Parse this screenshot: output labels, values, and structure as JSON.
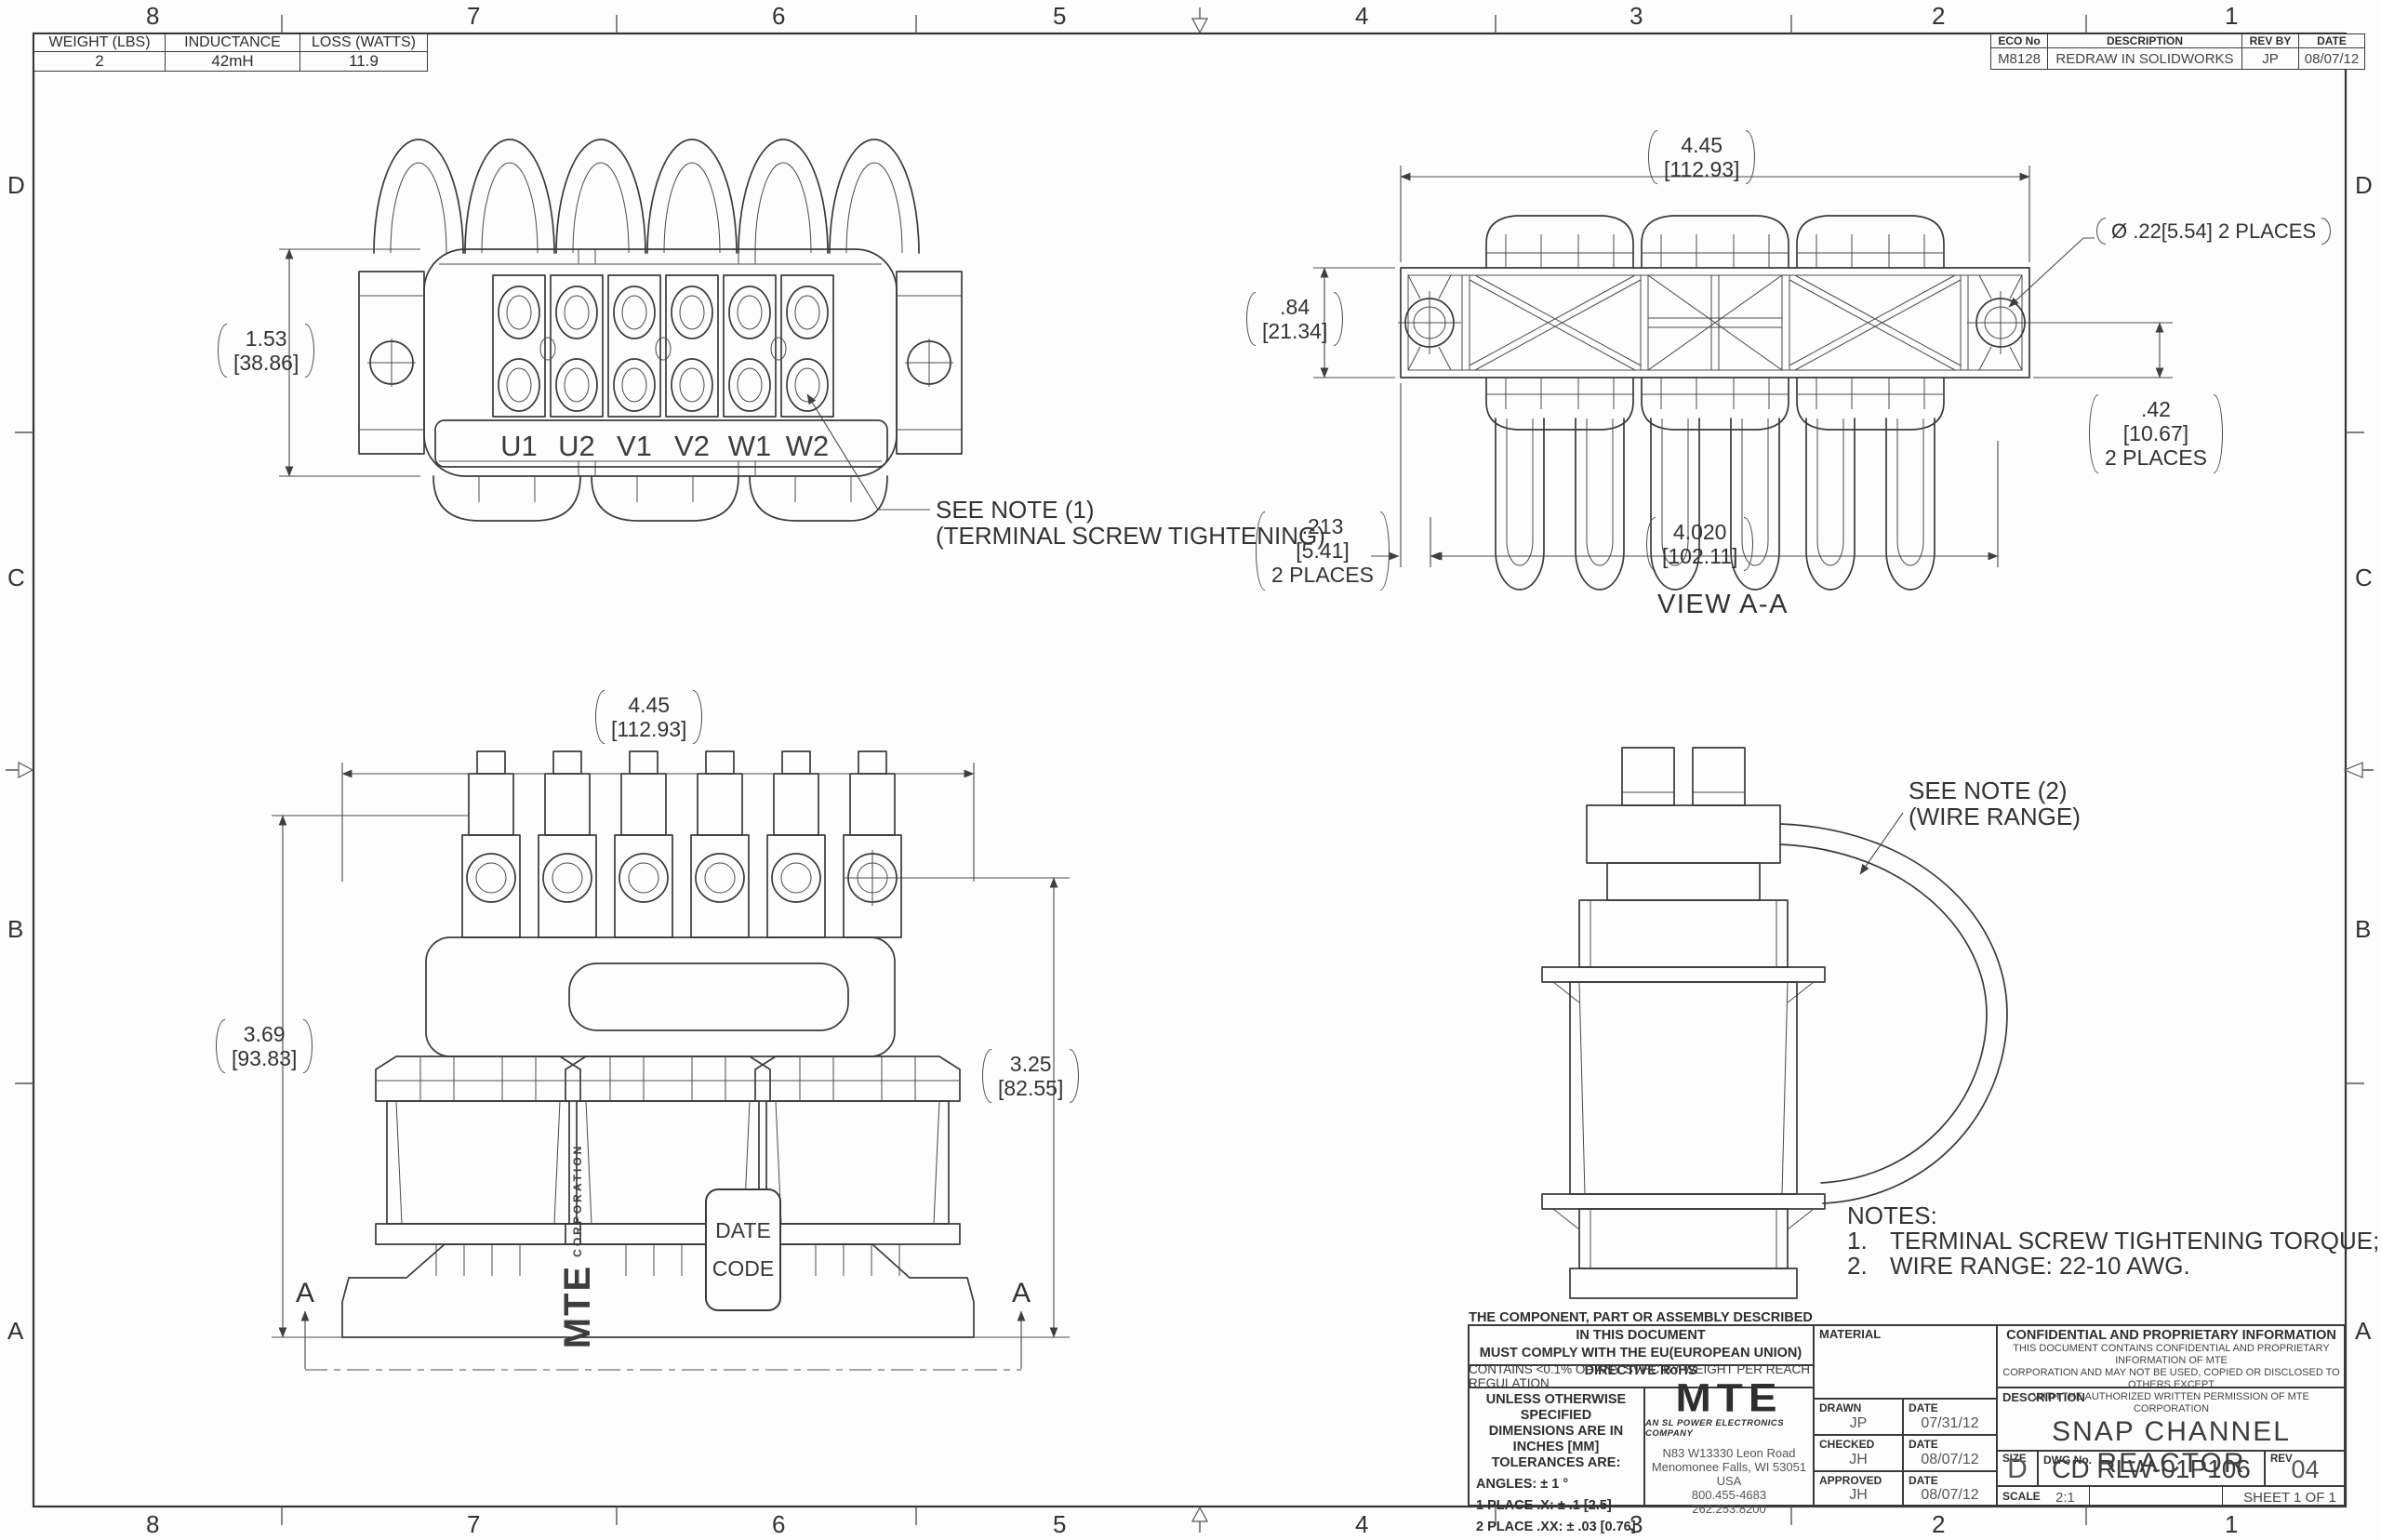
{
  "sheet": {
    "zones_top": [
      "8",
      "7",
      "6",
      "5",
      "4",
      "3",
      "2",
      "1"
    ],
    "zones_side": [
      "D",
      "C",
      "B",
      "A"
    ]
  },
  "spec_table": {
    "headers": [
      "WEIGHT (LBS)",
      "INDUCTANCE",
      "LOSS (WATTS)"
    ],
    "values": [
      "2",
      "42mH",
      "11.9"
    ]
  },
  "eco_table": {
    "headers": [
      "ECO No",
      "DESCRIPTION",
      "REV BY",
      "DATE"
    ],
    "eco_no": "M8128",
    "description": "REDRAW IN SOLIDWORKS",
    "rev_by": "JP",
    "date": "08/07/12"
  },
  "top_view": {
    "dim_height_in": "1.53",
    "dim_height_mm": "[38.86]",
    "terminals": [
      "U1",
      "U2",
      "V1",
      "V2",
      "W1",
      "W2"
    ],
    "note_ref_l1": "SEE NOTE (1)",
    "note_ref_l2": "(TERMINAL SCREW TIGHTENING)"
  },
  "view_aa": {
    "label": "VIEW A-A",
    "dim_width_in": "4.45",
    "dim_width_mm": "[112.93]",
    "hole_callout": "Ø .22[5.54] 2 PLACES",
    "dim_height_in": ".84",
    "dim_height_mm": "[21.34]",
    "dim_offset_in": ".42",
    "dim_offset_mm": "[10.67]",
    "dim_offset_note": "2 PLACES",
    "dim_end_in": ".213",
    "dim_end_mm": "[5.41]",
    "dim_end_note": "2 PLACES",
    "dim_slot_in": "4.020",
    "dim_slot_mm": "[102.11]"
  },
  "front_view": {
    "dim_width_in": "4.45",
    "dim_width_mm": "[112.93]",
    "dim_height_in": "3.69",
    "dim_height_mm": "[93.83]",
    "dim_height2_in": "3.25",
    "dim_height2_mm": "[82.55]",
    "section_letter": "A",
    "brand": "MTE",
    "brand_sub": "CORPORATION",
    "date_code_l1": "DATE",
    "date_code_l2": "CODE"
  },
  "side_view": {
    "note_ref_l1": "SEE NOTE (2)",
    "note_ref_l2": "(WIRE RANGE)"
  },
  "notes": {
    "title": "NOTES:",
    "items": [
      {
        "num": "1.",
        "text": "TERMINAL SCREW TIGHTENING TORQUE;  4.5 in-lb MAX."
      },
      {
        "num": "2.",
        "text": "WIRE RANGE:  22-10 AWG."
      }
    ]
  },
  "title_block": {
    "compliance_l1": "THE COMPONENT, PART OR ASSEMBLY DESCRIBED IN THIS DOCUMENT",
    "compliance_l2": "MUST COMPLY WITH THE EU(EUROPEAN UNION) DIRECTIVE RoHS",
    "reach": "CONTAINS <0.1% OF ANY SVHC BY WEIGHT PER REACH REGULATION",
    "tol_h1": "UNLESS OTHERWISE SPECIFIED",
    "tol_h2": "DIMENSIONS ARE IN INCHES [MM]",
    "tol_h3": "TOLERANCES ARE:",
    "tol_angles": "ANGLES: ± 1 °",
    "tol_p1": "1 PLACE .X: ± .1 [2.5]",
    "tol_p2": "2 PLACE .XX: ± .03 [0.76]",
    "tol_p3": "3 PLACE .XXX: ± .010 [0.254]",
    "logo": "MTE",
    "logo_tagline": "AN SL POWER ELECTRONICS COMPANY",
    "address_l1": "N83 W13330 Leon Road",
    "address_l2": "Menomonee Falls, WI 53051 USA",
    "address_l3": "800.455-4683",
    "address_l4": "262.253.8200",
    "material_label": "MATERIAL",
    "date_label": "DATE",
    "signoff": [
      {
        "role": "DRAWN",
        "initials": "JP",
        "date": "07/31/12"
      },
      {
        "role": "CHECKED",
        "initials": "JH",
        "date": "08/07/12"
      },
      {
        "role": "APPROVED",
        "initials": "JH",
        "date": "08/07/12"
      }
    ],
    "confidential_title": "CONFIDENTIAL AND PROPRIETARY INFORMATION",
    "confidential_l1": "THIS DOCUMENT CONTAINS CONFIDENTIAL AND PROPRIETARY INFORMATION OF MTE",
    "confidential_l2": "CORPORATION AND MAY NOT BE USED, COPIED OR DISCLOSED TO OTHERS EXCEPT",
    "confidential_l3": "WITH THE AUTHORIZED WRITTEN PERMISSION OF MTE CORPORATION",
    "description_label": "DESCRIPTION",
    "description": "SNAP CHANNEL REACTOR",
    "size_label": "SIZE",
    "size": "D",
    "dwg_label": "DWG No.",
    "dwg_no": "CD RLW-01P106",
    "rev_label": "REV",
    "rev": "04",
    "scale_label": "SCALE",
    "scale": "2:1",
    "sheet": "SHEET 1  OF 1"
  }
}
